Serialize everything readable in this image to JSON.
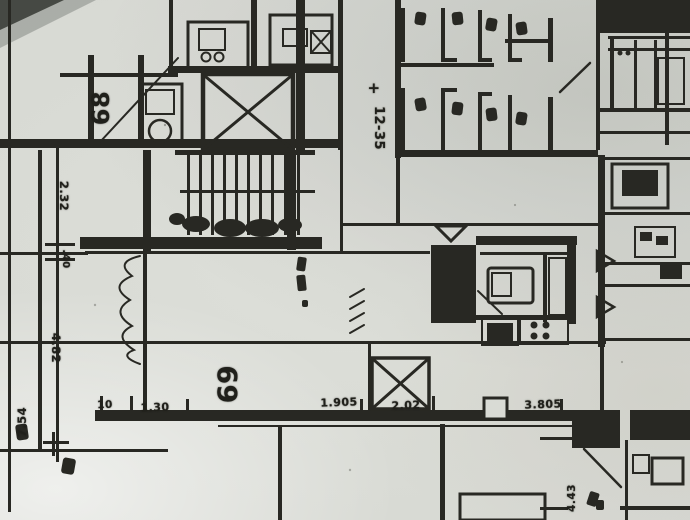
{
  "colors": {
    "ink": "#2b2b25",
    "paper": "#d6d8d2"
  },
  "labels": {
    "unit_68": "68",
    "unit_69": "69",
    "elevation_sign": "+",
    "elevation_value": "12-35",
    "left_dims": [
      "2.32",
      ".40",
      "4.82",
      "7.54"
    ],
    "bottom_dims": [
      "10",
      "1.30",
      "1.905",
      "2.02",
      "3.805"
    ],
    "right_dim": "4.43"
  }
}
